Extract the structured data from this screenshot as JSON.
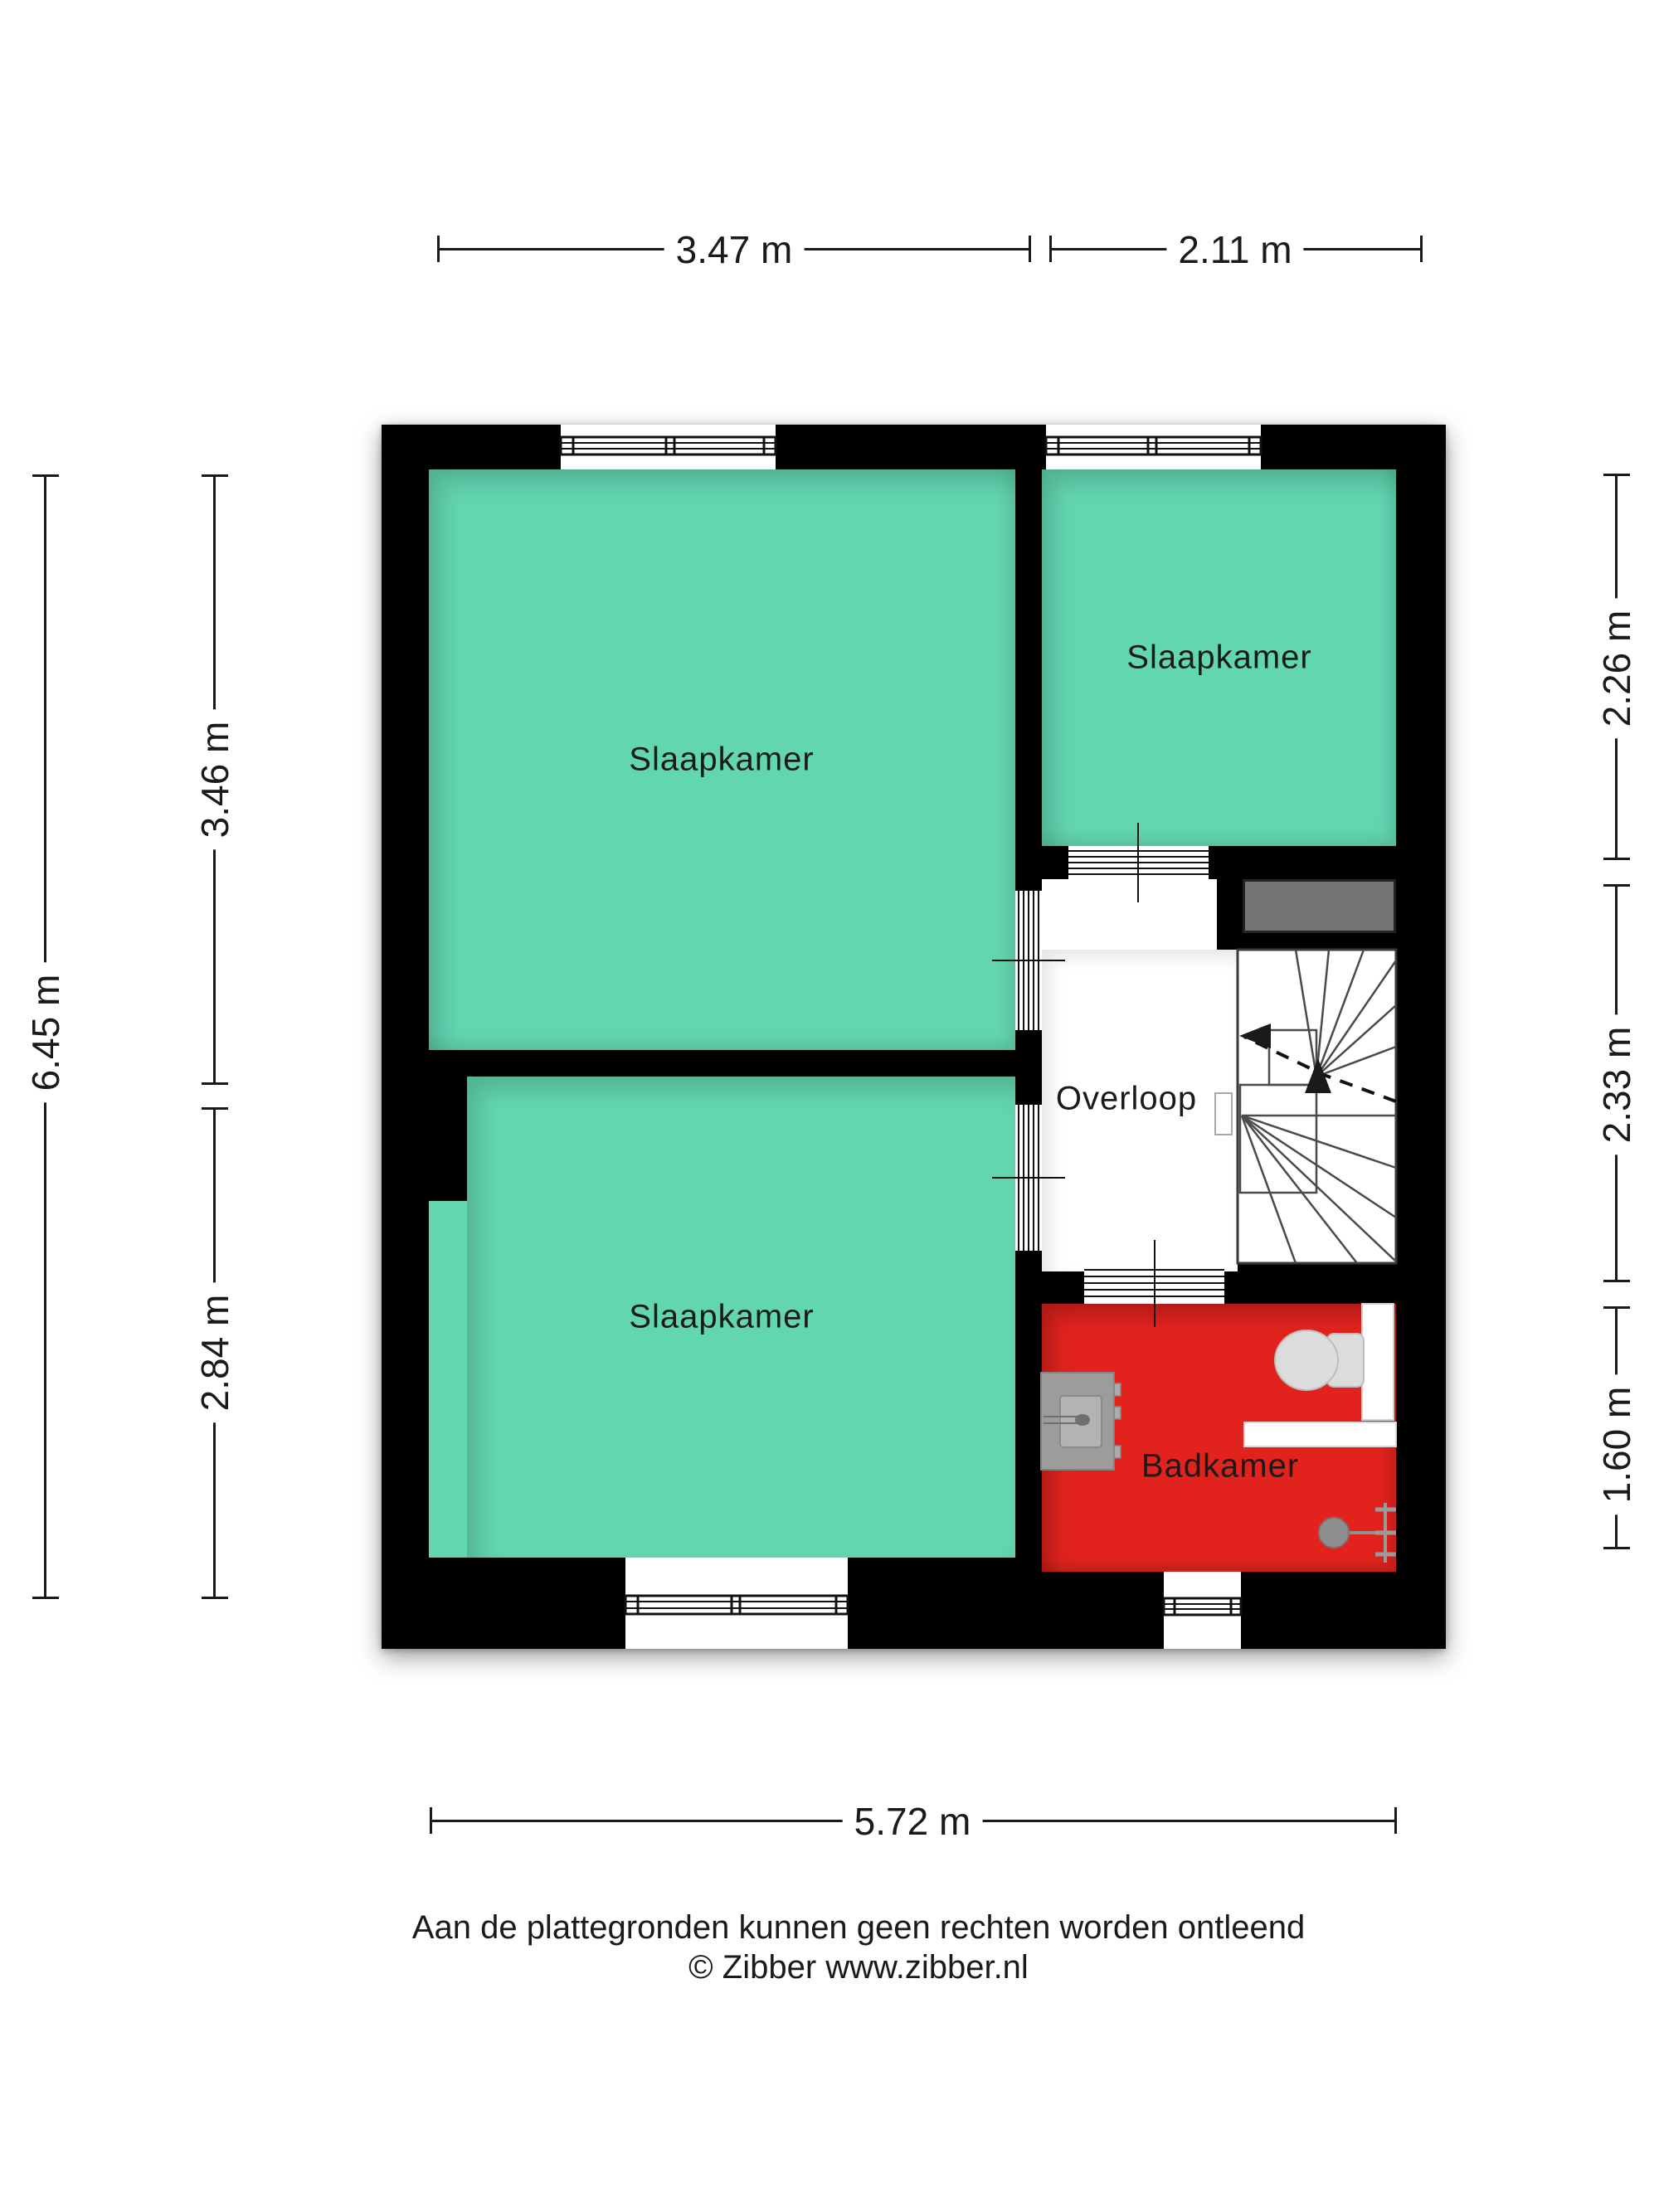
{
  "title": "Floor plan - first floor (verdieping)",
  "rooms": [
    {
      "id": "bedroom-large",
      "label": "Slaapkamer"
    },
    {
      "id": "bedroom-top-right",
      "label": "Slaapkamer"
    },
    {
      "id": "bedroom-bottom-left",
      "label": "Slaapkamer"
    },
    {
      "id": "landing",
      "label": "Overloop"
    },
    {
      "id": "bathroom",
      "label": "Badkamer"
    }
  ],
  "dimensions": {
    "unit": "m",
    "top": [
      {
        "label": "3.47 m"
      },
      {
        "label": "2.11 m"
      }
    ],
    "bottom": [
      {
        "label": "5.72 m"
      }
    ],
    "left_outer": [
      {
        "label": "6.45 m"
      }
    ],
    "left_inner": [
      {
        "label": "3.46 m"
      },
      {
        "label": "2.84 m"
      }
    ],
    "right": [
      {
        "label": "2.26 m"
      },
      {
        "label": "2.33 m"
      },
      {
        "label": "1.60 m"
      }
    ]
  },
  "fixtures": [
    {
      "name": "staircase-icon"
    },
    {
      "name": "toilet-icon"
    },
    {
      "name": "shower-icon"
    },
    {
      "name": "washbasin-icon"
    },
    {
      "name": "storage-block-icon"
    },
    {
      "name": "window-icon"
    },
    {
      "name": "door-opening-icon"
    }
  ],
  "footer": {
    "line1": "Aan de plattegronden kunnen geen rechten worden ontleend",
    "line2": "© Zibber www.zibber.nl"
  },
  "colors": {
    "wall": "#000000",
    "teal": "#62D5B1",
    "red": "#E2231D",
    "gray-block": "#757575",
    "dim": "#1a1a1a",
    "text": "#1a1a1a",
    "fixture-gray": "#9C9C9C",
    "toilet-gray": "#DCDCDC"
  }
}
